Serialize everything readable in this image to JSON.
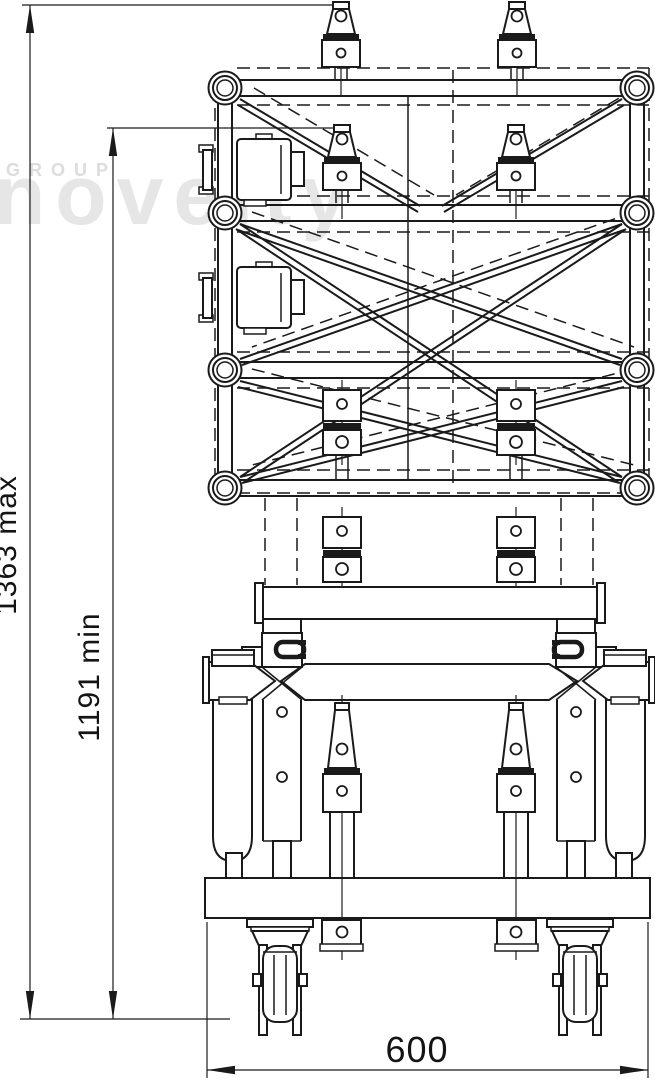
{
  "drawing": {
    "type": "technical-drawing",
    "subject": "truss tower lifting sleeve on wheeled ground-support base, front elevation",
    "watermark": {
      "group_label": "GROUP",
      "brand_label": "novelty"
    },
    "dimensions": {
      "height_max_label": "1363 max",
      "height_min_label": "1191 min",
      "width_label": "600"
    },
    "colors": {
      "line": "#1a1a1a",
      "background": "#ffffff",
      "watermark_brand": "#e6e6e6",
      "watermark_group": "#dcdcdc"
    }
  }
}
